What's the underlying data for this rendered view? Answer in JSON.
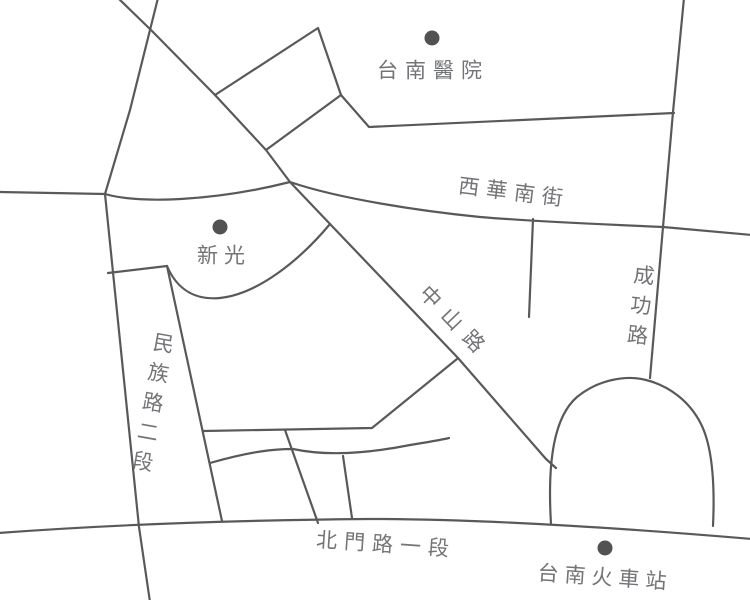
{
  "colors": {
    "road_line": "#58595b",
    "marker_dot": "#515254",
    "pin_red": "#e60012",
    "label_text": "#737477",
    "background": "#ffffff"
  },
  "pois": [
    {
      "id": "tainan-hospital",
      "label": "台南醫院"
    },
    {
      "id": "shinkong",
      "label": "新光"
    },
    {
      "id": "tainan-train-station",
      "label": "台南火車站"
    }
  ],
  "roads": [
    {
      "id": "xihua-south-street",
      "label": "西華南街"
    },
    {
      "id": "zhongshan-road",
      "label": "中山路"
    },
    {
      "id": "chenggong-road",
      "label": "成功路"
    },
    {
      "id": "minzu-road-section-2",
      "label": "民族路二段"
    },
    {
      "id": "beimen-road-section-1",
      "label": "北門路一段"
    }
  ]
}
